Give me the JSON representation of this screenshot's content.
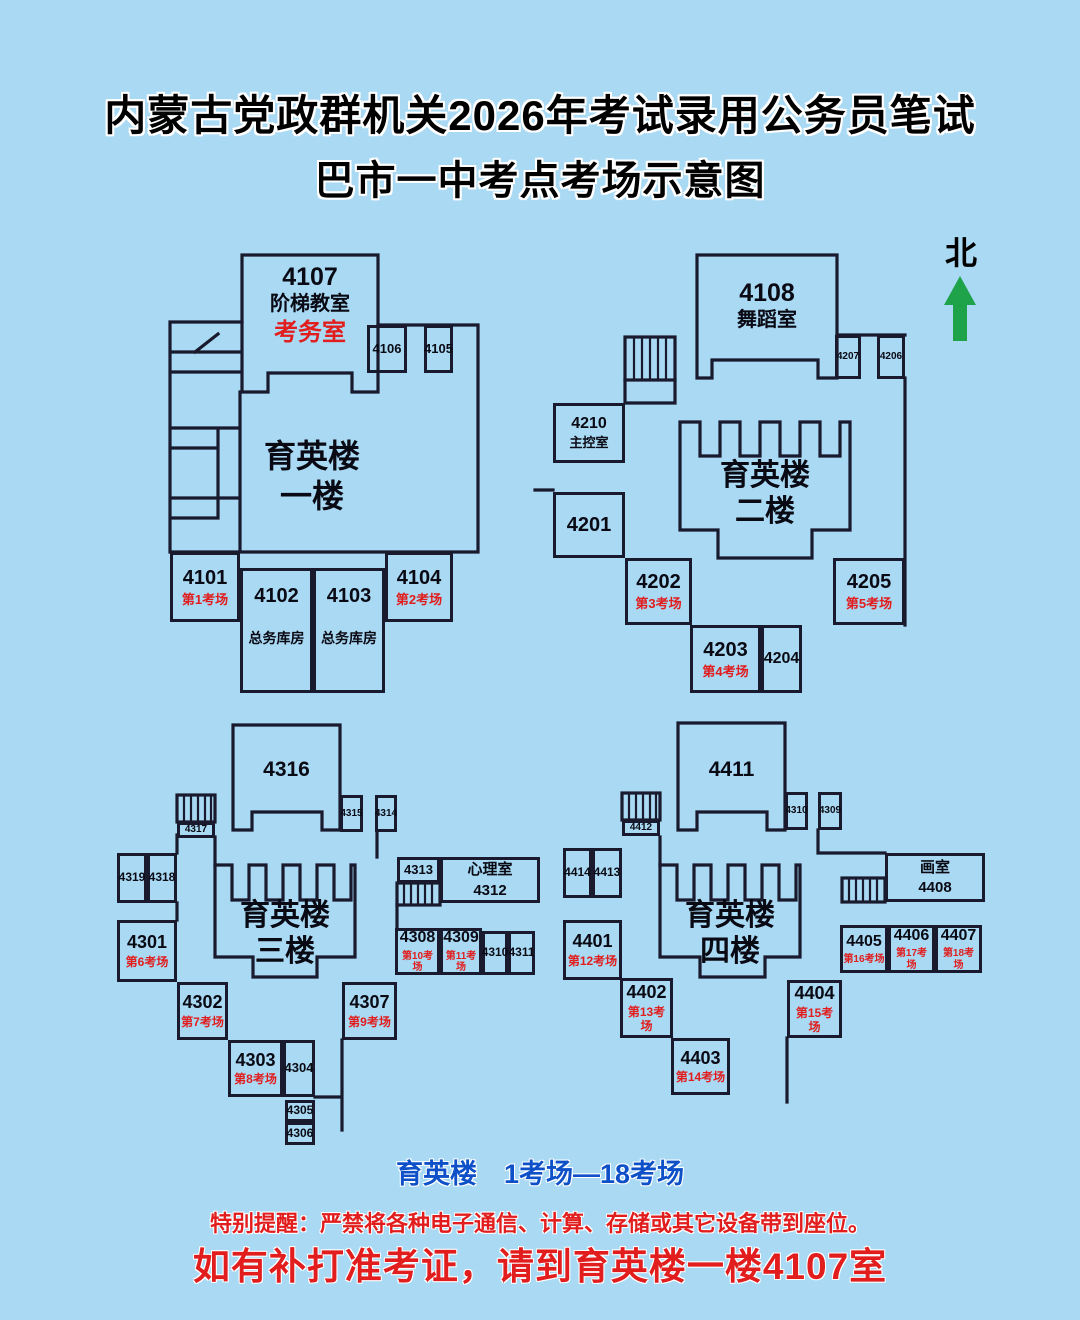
{
  "title": {
    "line1": "内蒙古党政群机关2026年考试录用公务员笔试",
    "line2": "巴市一中考点考场示意图"
  },
  "compass": {
    "label": "北"
  },
  "floor1": {
    "main": {
      "num": "4107",
      "name": "阶梯教室",
      "special": "考务室"
    },
    "hall1": "育英楼",
    "hall2": "一楼",
    "r4106": "4106",
    "r4105": "4105",
    "r4101": {
      "num": "4101",
      "sub": "第1考场"
    },
    "r4102": {
      "num": "4102",
      "sub": "总务库房"
    },
    "r4103": {
      "num": "4103",
      "sub": "总务库房"
    },
    "r4104": {
      "num": "4104",
      "sub": "第2考场"
    }
  },
  "floor2": {
    "main": {
      "num": "4108",
      "name": "舞蹈室"
    },
    "hall1": "育英楼",
    "hall2": "二楼",
    "r4207": "4207",
    "r4206": "4206",
    "r4210": {
      "num": "4210",
      "sub": "主控室"
    },
    "r4201": "4201",
    "r4202": {
      "num": "4202",
      "sub": "第3考场"
    },
    "r4203": {
      "num": "4203",
      "sub": "第4考场"
    },
    "r4204": "4204",
    "r4205": {
      "num": "4205",
      "sub": "第5考场"
    }
  },
  "floor3": {
    "main": {
      "num": "4316"
    },
    "hall1": "育英楼",
    "hall2": "三楼",
    "r4315": "4315",
    "r4314": "4314",
    "r4317": "4317",
    "r4319": "4319",
    "r4318": "4318",
    "r4313": "4313",
    "r4312": {
      "name": "心理室",
      "num": "4312"
    },
    "r4301": {
      "num": "4301",
      "sub": "第6考场"
    },
    "r4302": {
      "num": "4302",
      "sub": "第7考场"
    },
    "r4303": {
      "num": "4303",
      "sub": "第8考场"
    },
    "r4304": "4304",
    "r4305": "4305",
    "r4306": "4306",
    "r4307": {
      "num": "4307",
      "sub": "第9考场"
    },
    "r4308": {
      "num": "4308",
      "sub": "第10考场"
    },
    "r4309": {
      "num": "4309",
      "sub": "第11考场"
    },
    "r4310": "4310",
    "r4311": "4311"
  },
  "floor4": {
    "main": {
      "num": "4411"
    },
    "hall1": "育英楼",
    "hall2": "四楼",
    "r4310": "4310",
    "r4309": "4309",
    "r4412": "4412",
    "r4414": "4414",
    "r4413": "4413",
    "r4408": {
      "name": "画室",
      "num": "4408"
    },
    "r4401": {
      "num": "4401",
      "sub": "第12考场"
    },
    "r4402": {
      "num": "4402",
      "sub": "第13考场"
    },
    "r4403": {
      "num": "4403",
      "sub": "第14考场"
    },
    "r4404": {
      "num": "4404",
      "sub": "第15考场"
    },
    "r4405": {
      "num": "4405",
      "sub": "第16考场"
    },
    "r4406": {
      "num": "4406",
      "sub": "第17考场"
    },
    "r4407": {
      "num": "4407",
      "sub": "第18考场"
    }
  },
  "legend": {
    "text": "育英楼　1考场—18考场"
  },
  "notices": {
    "warning": "特别提醒：严禁将各种电子通信、计算、存储或其它设备带到座位。",
    "reprint": "如有补打准考证，请到育英楼一楼4107室"
  },
  "colors": {
    "background": "#a9d9f3",
    "wall": "#1a1a2e",
    "red": "#e11d1d",
    "blue": "#0d50c8",
    "green": "#1ea34b"
  }
}
